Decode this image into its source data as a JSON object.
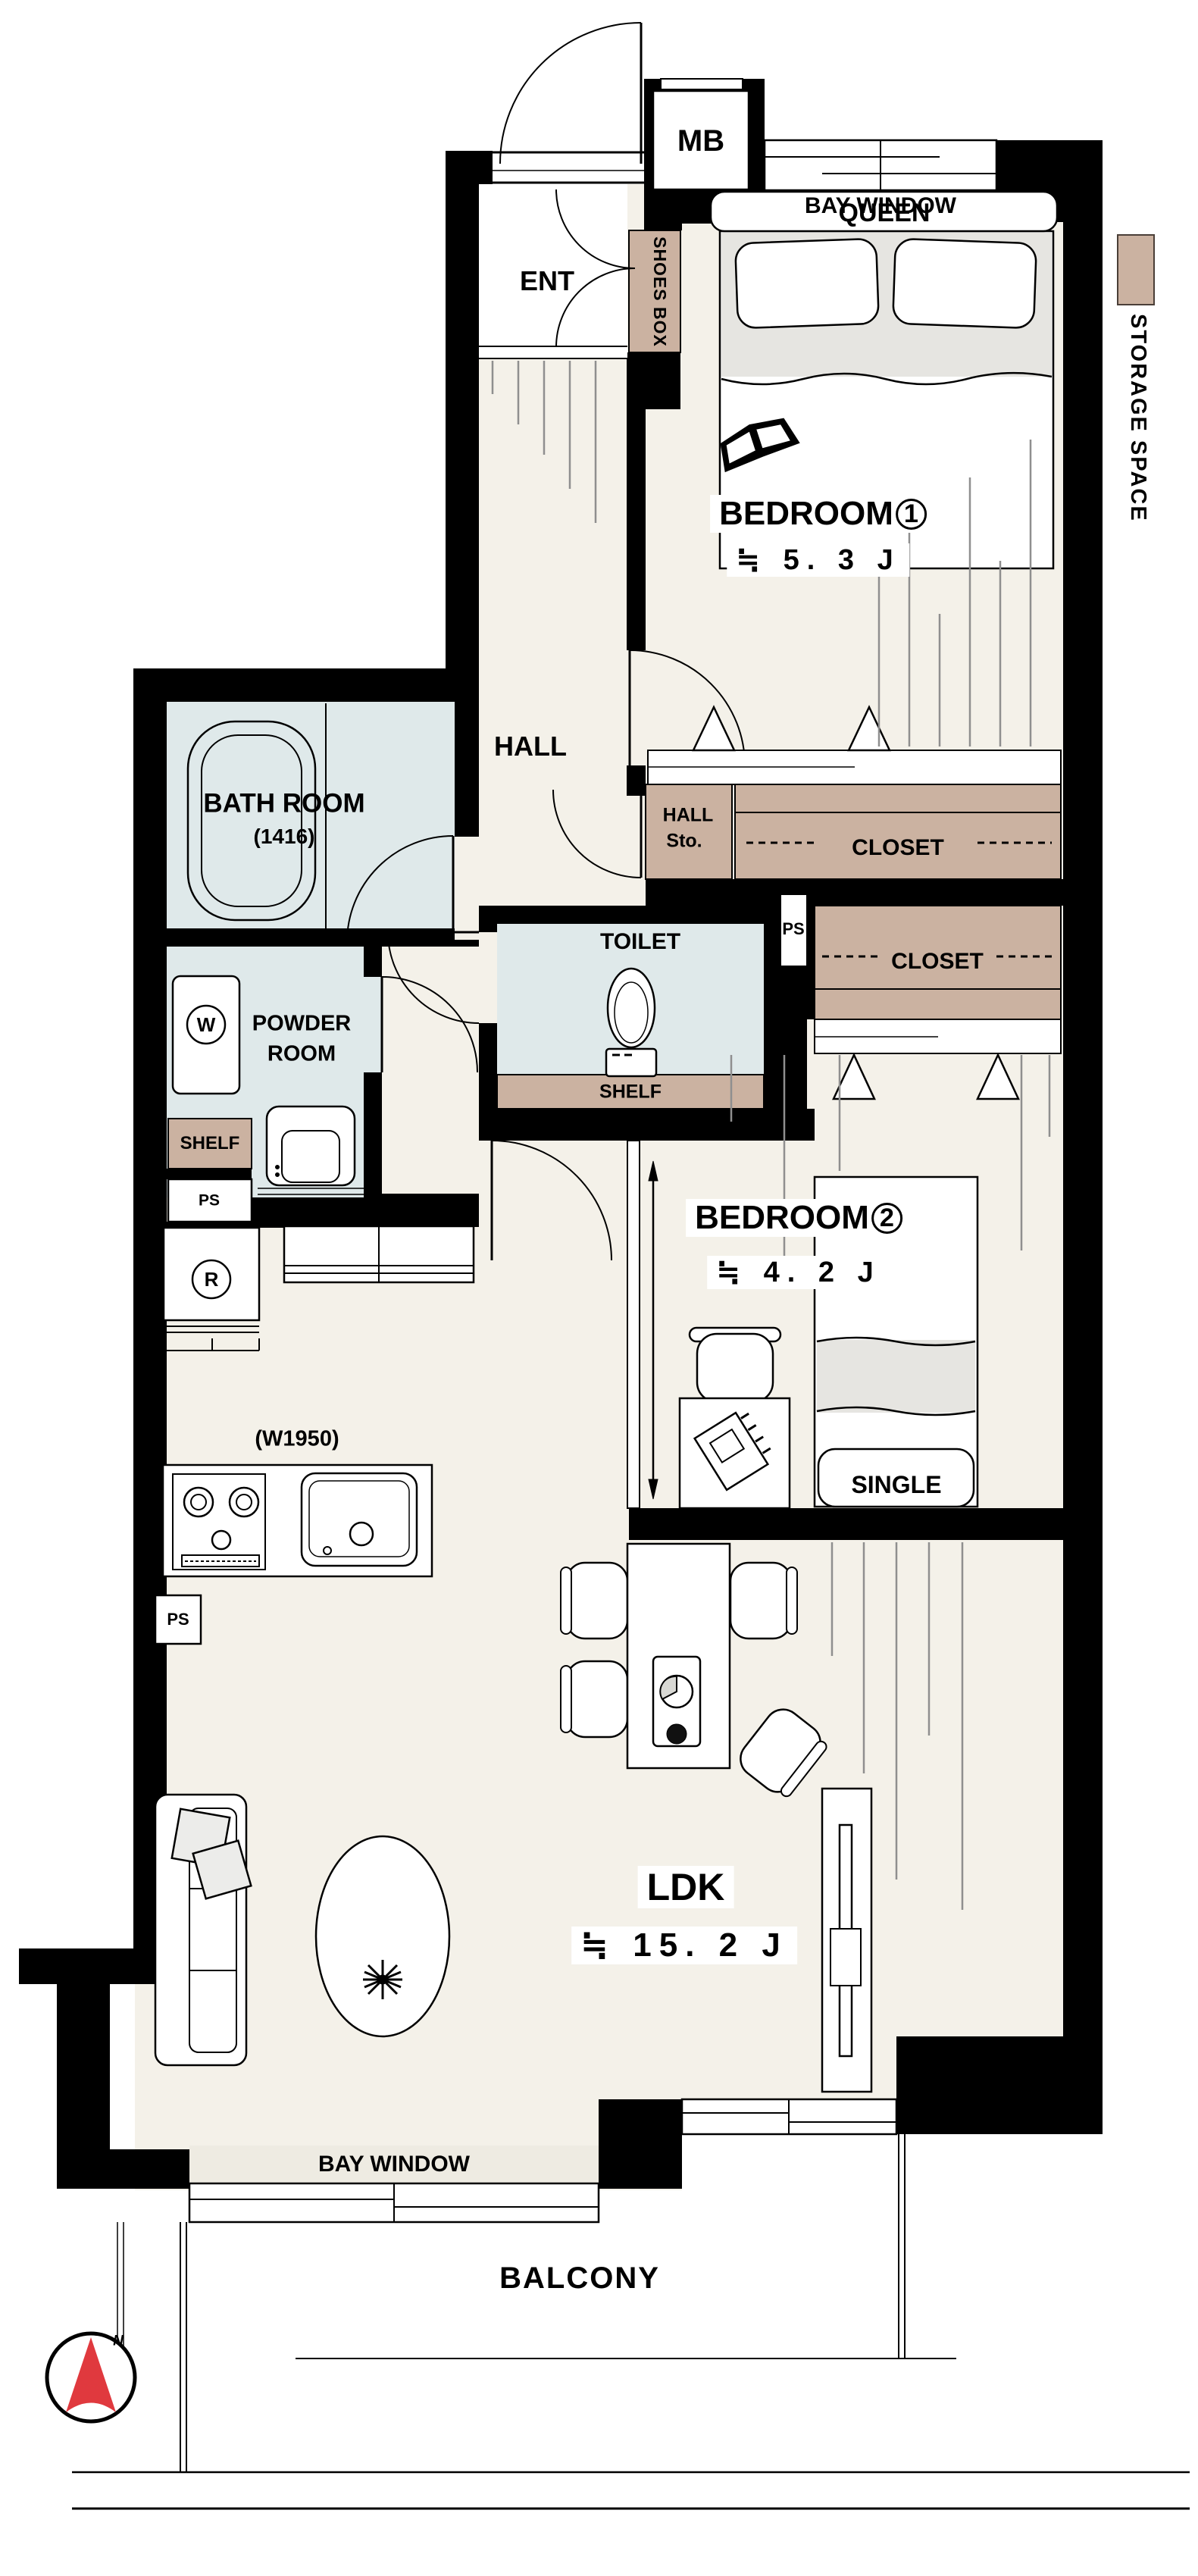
{
  "page": {
    "background": "#ffffff"
  },
  "colors": {
    "wall": "#000000",
    "floor_cream": "#f4f1e9",
    "storage_tan": "#cbb2a1",
    "wet_area_blue": "#dfe9ea",
    "bedding_grey": "#e6e5e1",
    "hatch_grey": "#8f8f8f",
    "compass_red": "#e0393e"
  },
  "plan": {
    "entrance": {
      "label": "ENT",
      "shoes_box": "SHOES BOX",
      "meter_box": "MB"
    },
    "bedroom1": {
      "name": "BEDROOM",
      "number": "1",
      "size": "≒ 5. 3 J",
      "bed": "QUEEN",
      "bay_window": "BAY WINDOW",
      "closet": "CLOSET"
    },
    "hall": {
      "label": "HALL",
      "storage_line1": "HALL",
      "storage_line2": "Sto."
    },
    "bathroom": {
      "name": "BATH ROOM",
      "size": "(1416)"
    },
    "powder_room": {
      "name_line1": "POWDER",
      "name_line2": "ROOM",
      "washer": "W",
      "shelf": "SHELF",
      "pipe_space": "PS",
      "refrigerator": "R"
    },
    "toilet": {
      "label": "TOILET",
      "shelf": "SHELF",
      "pipe_space": "PS"
    },
    "bedroom2": {
      "name": "BEDROOM",
      "number": "2",
      "size": "≒ 4. 2 J",
      "bed": "SINGLE",
      "closet": "CLOSET"
    },
    "kitchen": {
      "width_note": "(W1950)",
      "pipe_space": "PS"
    },
    "ldk": {
      "name": "LDK",
      "size": "≒ 15. 2 J",
      "bay_window": "BAY WINDOW"
    },
    "balcony": {
      "label": "BALCONY"
    },
    "compass": {
      "north": "N"
    },
    "legend": {
      "storage_space": "STORAGE SPACE"
    }
  }
}
